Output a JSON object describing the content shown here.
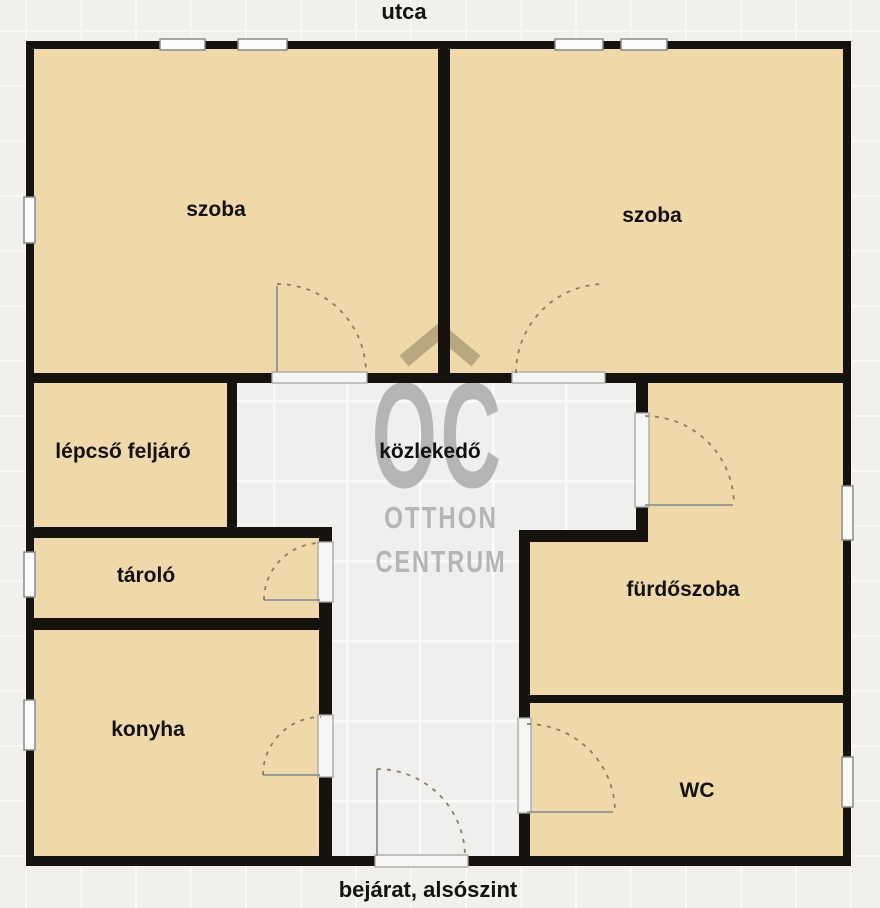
{
  "plan": {
    "street_label": "utca",
    "entrance_label": "bejárat, alsószint",
    "rooms": {
      "szoba_left": "szoba",
      "szoba_right": "szoba",
      "lepcso": "lépcső feljáró",
      "kozlekedo": "közlekedő",
      "tarolo": "tároló",
      "furdoszoba": "fürdőszoba",
      "konyha": "konyha",
      "wc": "WC"
    },
    "watermark": {
      "logo": "OC",
      "line1": "OTTHON",
      "line2": "CENTRUM"
    },
    "colors": {
      "wall": "#16120e",
      "room_fill": "#efd8aa",
      "hallway_fill": "#efefed",
      "background": "#f1f0ed",
      "grid_line": "#f9f8f5",
      "watermark_gray": "#b5b5b3",
      "roof_tan": "#b5a47e",
      "door_arc": "#8d7c5e",
      "door_leaf": "#9a9a98",
      "window_fill": "#fcfcfc",
      "window_frame": "#8a8a8a",
      "label": "#141210"
    }
  }
}
